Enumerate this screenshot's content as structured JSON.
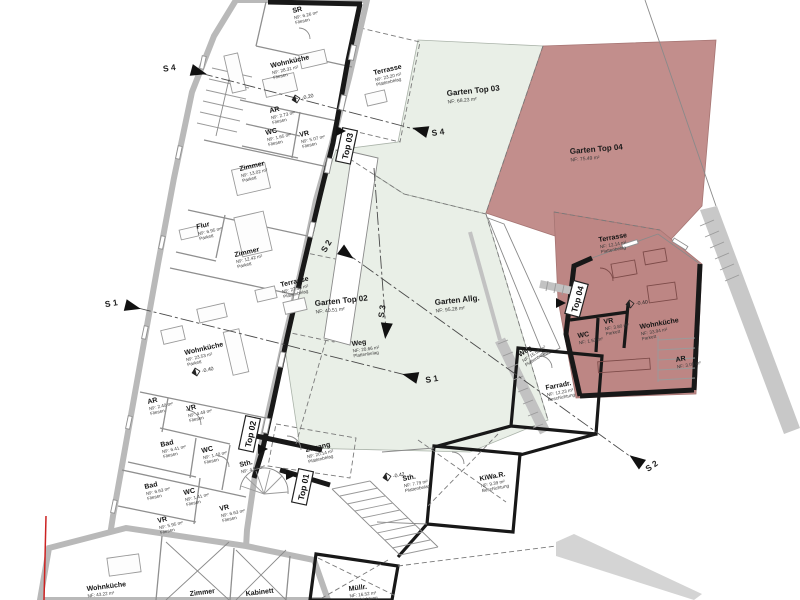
{
  "colors": {
    "garden_green": "#e9efe7",
    "garden_red": "#c28e8c",
    "unit_red": "#bd8684",
    "wall_gray": "#bcbcbc",
    "wall_dark": "#1b1b1b",
    "boundary_red": "#cc2222"
  },
  "rooms": {
    "sr": {
      "name": "SR",
      "area": "NF: 6.26 m²",
      "floor": "Fliesen"
    },
    "wk1": {
      "name": "Wohnküche",
      "area": "NF: 28.31 m²",
      "floor": "Fliesen"
    },
    "ar1": {
      "name": "AR",
      "area": "NF: 2.73 m²",
      "floor": "Fliesen"
    },
    "wc1": {
      "name": "WC",
      "area": "NF: 1.65 m²",
      "floor": "Fliesen"
    },
    "vr1": {
      "name": "VR",
      "area": "NF: 5.07 m²",
      "floor": "Fliesen"
    },
    "zi1": {
      "name": "Zimmer",
      "area": "NF: 13.02 m²",
      "floor": "Parkett"
    },
    "flur": {
      "name": "Flur",
      "area": "NF: 6.95 m²",
      "floor": "Parkett"
    },
    "zi2": {
      "name": "Zimmer",
      "area": "NF: 12.42 m²",
      "floor": "Parkett"
    },
    "ter1": {
      "name": "Terrasse",
      "area": "NF: 27.30 m²",
      "floor": "Plattenbelag"
    },
    "wk2": {
      "name": "Wohnküche",
      "area": "NF: 23.53 m²",
      "floor": "Parkett"
    },
    "ar2": {
      "name": "AR",
      "area": "NF: 2.40 m²",
      "floor": "Fliesen"
    },
    "vr2": {
      "name": "VR",
      "area": "NF: 4.49 m²",
      "floor": "Fliesen"
    },
    "bad1": {
      "name": "Bad",
      "area": "NF: 6.41 m²",
      "floor": "Fliesen"
    },
    "wc2": {
      "name": "WC",
      "area": "NF: 1.40 m²",
      "floor": "Fliesen"
    },
    "sth1": {
      "name": "Sth.",
      "area": "NF: 4.98 m²",
      "floor": ""
    },
    "bad2": {
      "name": "Bad",
      "area": "NF: 6.63 m²",
      "floor": "Fliesen"
    },
    "wc3": {
      "name": "WC",
      "area": "NF: 1.41 m²",
      "floor": "Fliesen"
    },
    "vr3": {
      "name": "VR",
      "area": "NF: 5.95 m²",
      "floor": "Fliesen"
    },
    "vr4": {
      "name": "VR",
      "area": "NF: 6.63 m²",
      "floor": "Fliesen"
    },
    "tert": {
      "name": "Terrasse",
      "area": "NF: 23.20 m²",
      "floor": "Plattenbelag"
    },
    "zugang": {
      "name": "Zugang",
      "area": "NF: 20.14 m²",
      "floor": "Plattenbelag"
    },
    "sth2": {
      "name": "Sth.",
      "area": "NF: 7.79 m²",
      "floor": "Plattenbelag"
    },
    "kiwa": {
      "name": "KiWa.R.",
      "area": "NF: 9.39 m²",
      "floor": "Beschichtung"
    },
    "farradr": {
      "name": "Farradr.",
      "area": "NF: 12.23 m²",
      "floor": "Beschichtung"
    },
    "weg1": {
      "name": "Weg",
      "area": "NF: 20.66 m²",
      "floor": "Plattenbelag"
    },
    "weg2": {
      "name": "Weg",
      "area": "NF: 15.52 m²",
      "floor": "Plattenbelag"
    },
    "t4ter": {
      "name": "Terrasse",
      "area": "NF: 12.14 m²",
      "floor": "Plattenbelag"
    },
    "t4vr": {
      "name": "VR",
      "area": "NF: 3.80 m²",
      "floor": "Parkett"
    },
    "t4wc": {
      "name": "WC",
      "area": "NF: 1.53 m²",
      "floor": ""
    },
    "t4wk": {
      "name": "Wohnküche",
      "area": "NF: 33.94 m²",
      "floor": "Parkett"
    },
    "t4ar": {
      "name": "AR",
      "area": "NF: 3.09 m²",
      "floor": ""
    },
    "wk3": {
      "name": "Wohnküche",
      "area": "NF: 43.22 m²",
      "floor": ""
    },
    "zi3": {
      "name": "Zimmer",
      "area": "",
      "floor": ""
    },
    "kab": {
      "name": "Kabinett",
      "area": "",
      "floor": ""
    },
    "muell": {
      "name": "Müllr.",
      "area": "NF: 16.52 m²",
      "floor": "Beschichtung"
    }
  },
  "gardens": {
    "g02": {
      "name": "Garten Top 02",
      "area": "NF: 40.51 m²"
    },
    "g03": {
      "name": "Garten Top 03",
      "area": "NF: 68.23 m²"
    },
    "g04": {
      "name": "Garten Top 04",
      "area": "NF: 75.49 m²"
    },
    "gallg": {
      "name": "Garten Allg.",
      "area": "NF: 95.28 m²"
    }
  },
  "units": {
    "top01": "Top 01",
    "top02": "Top 02",
    "top03": "Top 03",
    "top04": "Top 04"
  },
  "sections": {
    "s1": "S 1",
    "s2": "S 2",
    "s3": "S 3",
    "s4": "S 4"
  },
  "elevations": {
    "e1": "-0.20",
    "e2": "-0.40",
    "e3": "-0.42",
    "e4": "-0.40"
  }
}
